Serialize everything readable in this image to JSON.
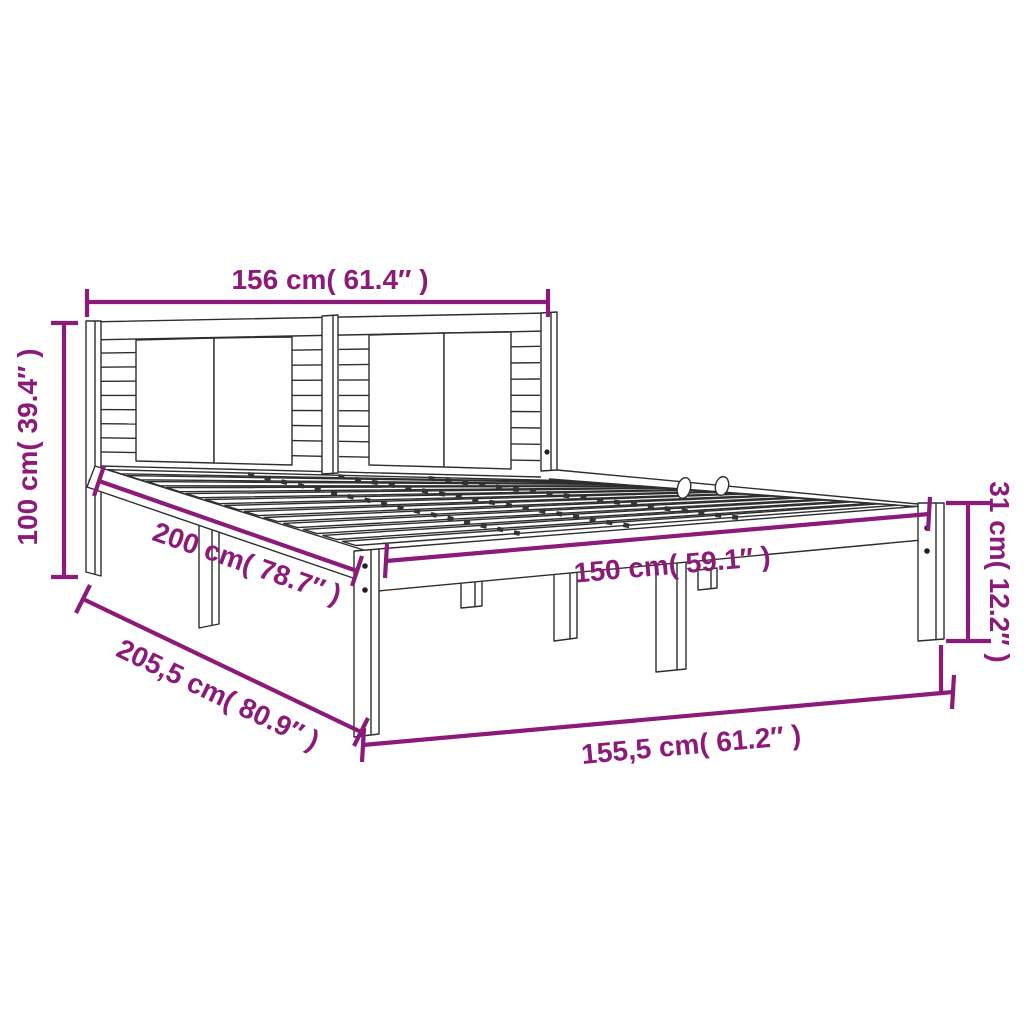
{
  "colors": {
    "annotation": "#8C1A78",
    "line_art": "#2e2e2e",
    "background": "#ffffff"
  },
  "annotations": {
    "headboard_width": {
      "text": "156 cm( 61.4″ )",
      "cm": "156",
      "inches": "61.4"
    },
    "headboard_height": {
      "text": "100 cm( 39.4″ )",
      "cm": "100",
      "inches": "39.4"
    },
    "inner_length": {
      "text": "200 cm( 78.7″ )",
      "cm": "200",
      "inches": "78.7"
    },
    "inner_width": {
      "text": "150 cm( 59.1″ )",
      "cm": "150",
      "inches": "59.1"
    },
    "frame_height": {
      "text": "31 cm( 12.2″ )",
      "cm": "31",
      "inches": "12.2"
    },
    "total_length": {
      "text": "205,5 cm( 80.9″ )",
      "cm": "205,5",
      "inches": "80.9"
    },
    "total_width": {
      "text": "155,5 cm( 61.2″ )",
      "cm": "155,5",
      "inches": "61.2"
    }
  }
}
